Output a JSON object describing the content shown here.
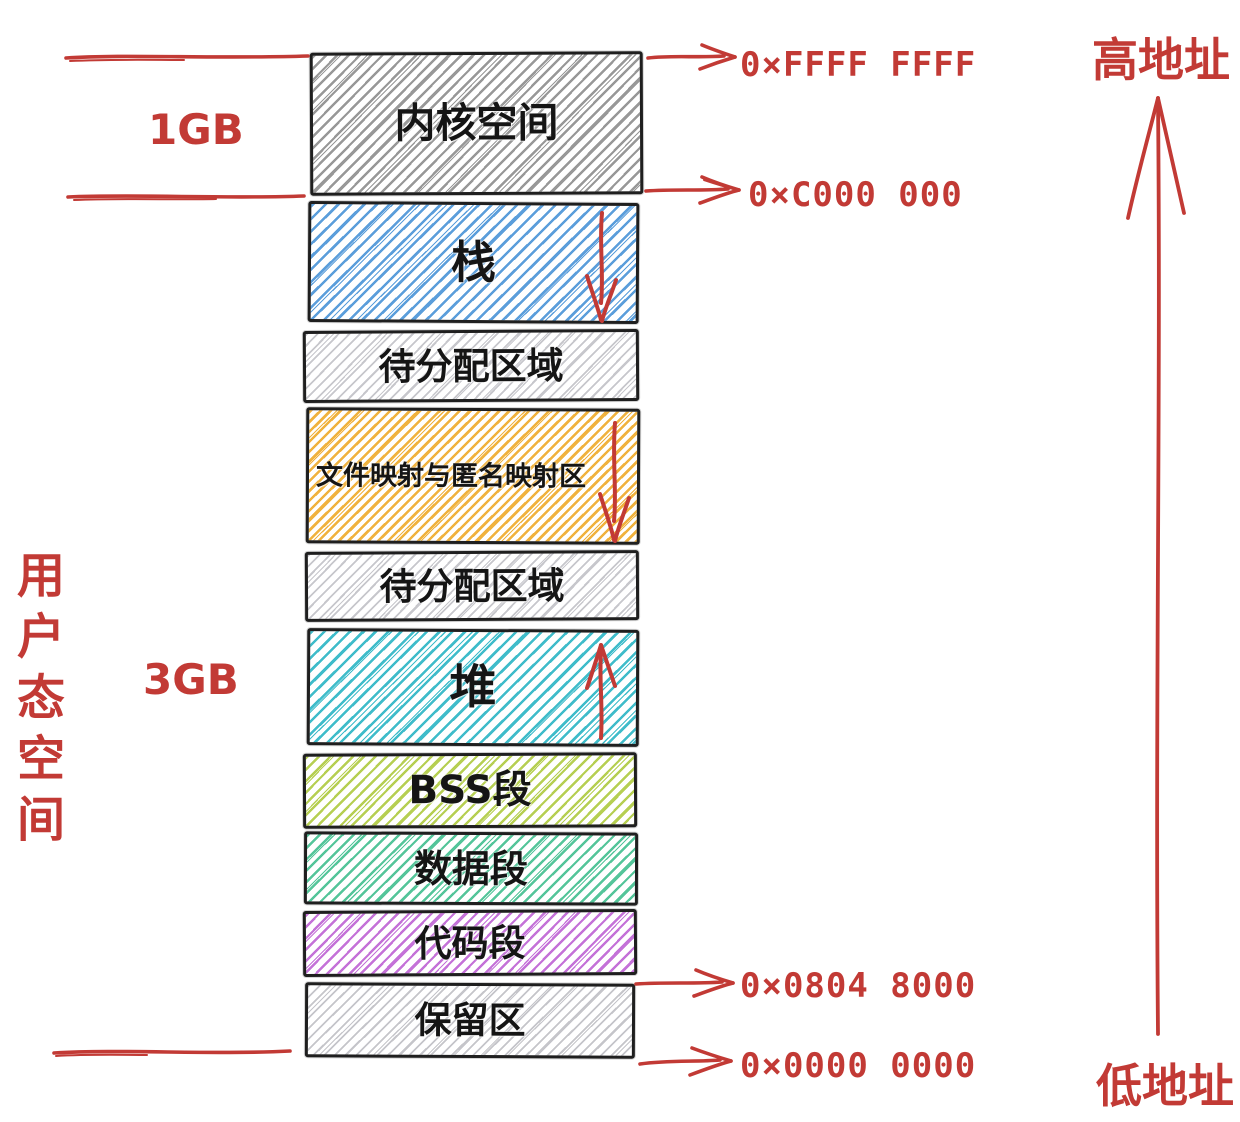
{
  "labels": {
    "kernel_size": "1GB",
    "user_size": "3GB",
    "user_space_vertical": "用户态空间",
    "high_address": "高地址",
    "low_address": "低地址"
  },
  "addresses": {
    "top": "0×FFFF FFFF",
    "kernel_base": "0×C000 000",
    "code_base": "0×0804 8000",
    "bottom": "0×0000 0000"
  },
  "segments": [
    {
      "label": "内核空间",
      "color": "#989898",
      "arrow": null
    },
    {
      "label": "栈",
      "color": "#5b9edb",
      "arrow": "down"
    },
    {
      "label": "待分配区域",
      "color": "#c7c7cc",
      "arrow": null
    },
    {
      "label": "文件映射与匿名映射区",
      "color": "#f0b23e",
      "arrow": "down"
    },
    {
      "label": "待分配区域",
      "color": "#c7c7cc",
      "arrow": null
    },
    {
      "label": "堆",
      "color": "#3fbcca",
      "arrow": "up"
    },
    {
      "label": "BSS段",
      "color": "#b6cf52",
      "arrow": null
    },
    {
      "label": "数据段",
      "color": "#54c59a",
      "arrow": null
    },
    {
      "label": "代码段",
      "color": "#c472d8",
      "arrow": null
    },
    {
      "label": "保留区",
      "color": "#c5c5ca",
      "arrow": null
    }
  ],
  "accent_color": "#c23a35"
}
